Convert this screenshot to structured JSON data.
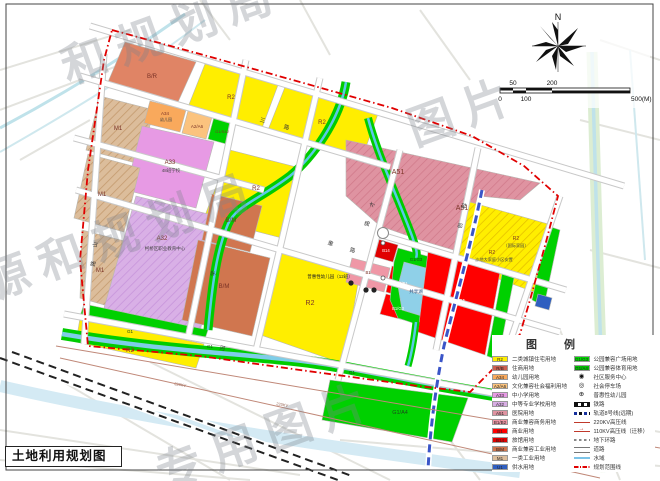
{
  "title_box": {
    "text": "土地利用规划图"
  },
  "compass": {
    "north_label": "N"
  },
  "scale_bar": {
    "top_labels": [
      "50",
      "200"
    ],
    "bottom_labels": [
      "0",
      "100",
      "500(M)"
    ]
  },
  "watermark": {
    "lines": [
      "和规划局",
      "源和规划局",
      "专用图片",
      "图片"
    ]
  },
  "legend": {
    "title": "图 例",
    "left": [
      {
        "code": "R2",
        "color": "#ffee00",
        "label": "二类城镇住宅用地"
      },
      {
        "code": "R/B",
        "color": "#cc5f50",
        "label": "住商用地"
      },
      {
        "code": "A34",
        "color": "#f9a95c",
        "label": "幼儿园用地"
      },
      {
        "code": "A2/A6",
        "color": "#fbc37e",
        "label": "文化兼容社会福利用地"
      },
      {
        "code": "A33",
        "color": "#e79ae4",
        "label": "中小学用地"
      },
      {
        "code": "A32",
        "color": "#d8aee4",
        "label": "中等专业学校用地"
      },
      {
        "code": "A51",
        "color": "#df93a1",
        "label": "医院用地"
      },
      {
        "code": "B1/B2",
        "color": "#ef97a6",
        "label": "商业兼容商务用地"
      },
      {
        "code": "B1",
        "color": "#ff0000",
        "label": "商业用地"
      },
      {
        "code": "B14",
        "color": "#e00000",
        "label": "旅馆用地"
      },
      {
        "code": "B/M",
        "color": "#d0764f",
        "label": "商业兼容工业用地"
      },
      {
        "code": "M1",
        "color": "#dcbd9b",
        "label": "一类工业用地"
      },
      {
        "code": "U1",
        "color": "#2f5fc0",
        "label": "供水用地"
      }
    ],
    "right": [
      {
        "code": "G1/G3",
        "color": "#00d800",
        "label": "公园兼容广场用地"
      },
      {
        "code": "G1/A4",
        "color": "#00c400",
        "label": "公园兼容体育用地"
      },
      {
        "icon": "◉",
        "label": "社区服务中心"
      },
      {
        "icon": "◎",
        "label": "社会停车场"
      },
      {
        "icon": "⊕",
        "label": "普惠性幼儿园"
      },
      {
        "label": "铁路"
      },
      {
        "label": "轨道8号线(远期)"
      },
      {
        "label": "220KV高压线"
      },
      {
        "label": "110KV高压线（迁移）"
      },
      {
        "label": "地下环路"
      },
      {
        "label": "道路"
      },
      {
        "label": "水域"
      },
      {
        "label": "规划范围线"
      }
    ]
  },
  "map": {
    "parcels": {
      "br": "B/R",
      "r2": "R2",
      "m1": "M1",
      "a34": "A34",
      "a34_note": "幼儿园",
      "a2a6": "A2/A6",
      "g1s42": "G1/S42",
      "a33": "A33",
      "a33_note": "48班学校",
      "a32": "A32",
      "a32_note": "柯桥区职业教育中心",
      "bm": "B/M",
      "a51": "A51",
      "r2_resettle1_code": "R2",
      "r2_resettle1_note": "（国际家园）",
      "r2_resettle2_code": "R2",
      "r2_resettle2_note": "沙地大家庭小区安置",
      "b14": "B14",
      "b1": "B1",
      "b2b1": "B2/B1",
      "b1g3": "B1/G3",
      "g1g3": "G1/G3",
      "lake": "共享湖",
      "g1": "G1",
      "g1a4": "G1/A4"
    },
    "callouts": {
      "kindergarten": "普惠性幼儿园（12班）"
    },
    "power_label": "220KV",
    "road_chars": {
      "c1": "三",
      "c2": "路",
      "c3": "重",
      "c4": "路",
      "c5": "才",
      "c6": "路",
      "c7": "山",
      "c8": "路",
      "c9": "科",
      "c10": "创",
      "c11": "河",
      "c12": "学"
    }
  }
}
